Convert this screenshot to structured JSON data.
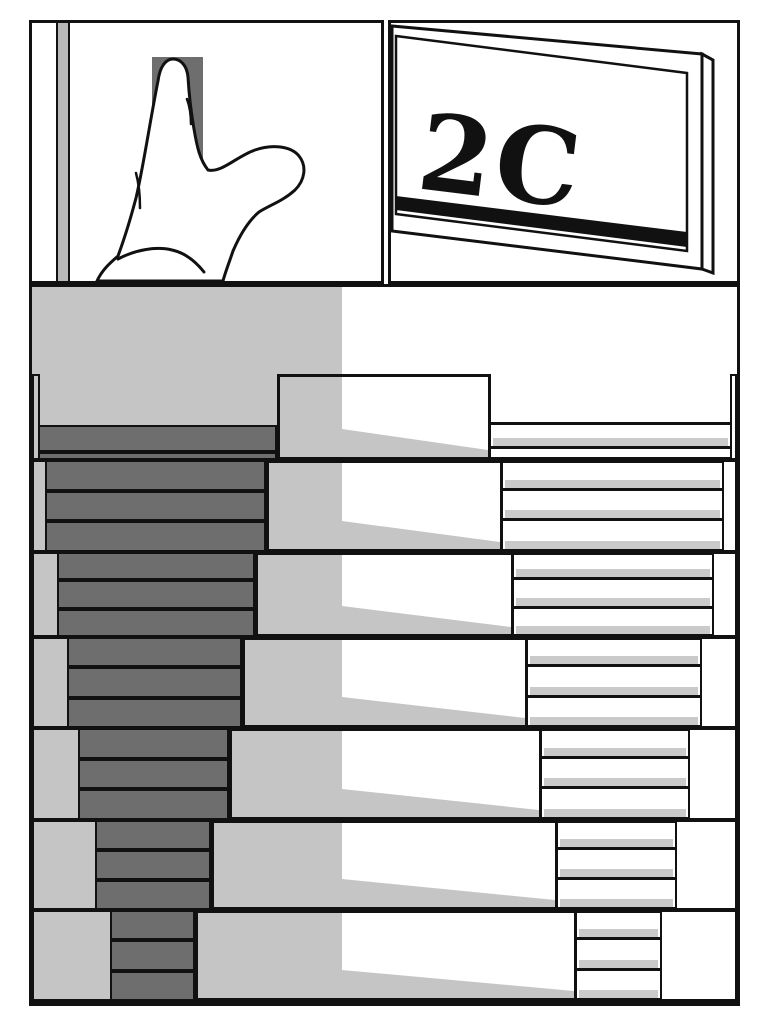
{
  "sign": {
    "text": "2C"
  },
  "colors": {
    "ink": "#111111",
    "panel_bg": "#ffffff",
    "light_gray": "#c5c5c5",
    "shadow_band": "#cacaca",
    "dark_gray": "#6e6e6e",
    "door_frame_gray": "#b8b8b8"
  },
  "illustrations": {
    "hand": "pointing-hand-pressing-doorbell",
    "sign": "apartment-door-sign",
    "stairs": "stairwell-seen-from-above"
  },
  "stairwell": {
    "center_x": 310,
    "right_edge": 705,
    "bottom": 714,
    "column": {
      "x0": 0,
      "y0": 0,
      "x1": 310,
      "y1": 714
    },
    "wedge": {
      "left_h": 28,
      "right_h": 7
    },
    "levels": [
      {
        "y0": 87,
        "y1": 173,
        "wallL": 6,
        "Lx": 245,
        "Rx": 459,
        "Fr": 698,
        "darkTreads": [
          [
            138,
            165
          ],
          [
            165,
            173
          ]
        ],
        "rightRows": [
          [
            135,
            162,
            true
          ],
          [
            162,
            173,
            false
          ]
        ]
      },
      {
        "y0": 173,
        "y1": 265,
        "wallL": 13,
        "Lx": 234,
        "Rx": 471,
        "Fr": 690
      },
      {
        "y0": 265,
        "y1": 350,
        "wallL": 25,
        "Lx": 223,
        "Rx": 482,
        "Fr": 680
      },
      {
        "y0": 350,
        "y1": 441,
        "wallL": 35,
        "Lx": 210,
        "Rx": 496,
        "Fr": 668
      },
      {
        "y0": 441,
        "y1": 533,
        "wallL": 46,
        "Lx": 197,
        "Rx": 510,
        "Fr": 656
      },
      {
        "y0": 533,
        "y1": 623,
        "wallL": 63,
        "Lx": 179,
        "Rx": 526,
        "Fr": 643
      },
      {
        "y0": 623,
        "y1": 714,
        "wallL": 78,
        "Lx": 163,
        "Rx": 545,
        "Fr": 628
      }
    ]
  }
}
